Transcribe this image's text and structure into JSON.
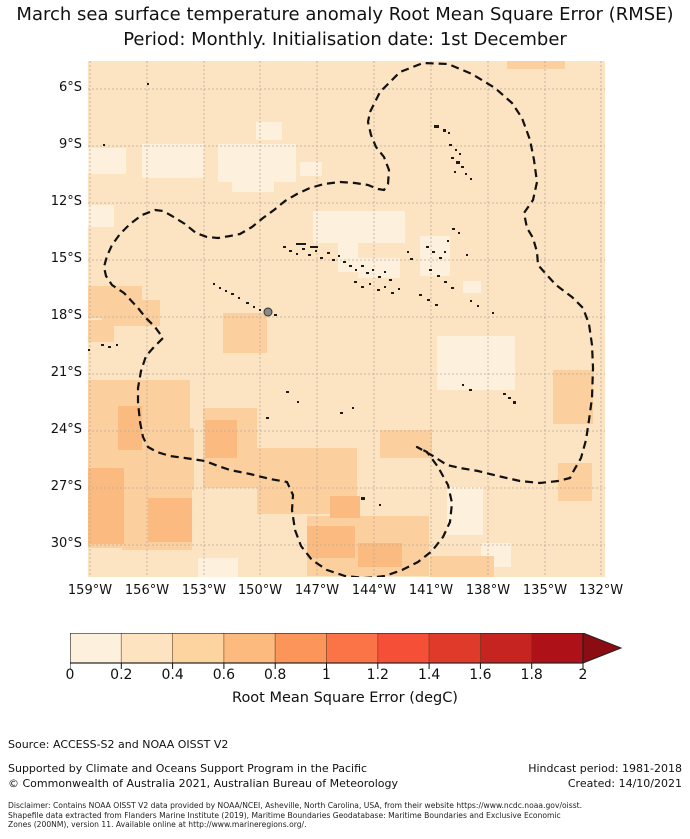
{
  "title": {
    "line1": "March sea surface temperature anomaly Root Mean Square Error (RMSE)",
    "line2": "Period: Monthly. Initialisation date: 1st December"
  },
  "map": {
    "x": 88,
    "y": 61,
    "width": 517,
    "height": 516,
    "base_color": "#fce3c1",
    "grid_color": "#b9ab9c",
    "lat_ticks": [
      "6°S",
      "9°S",
      "12°S",
      "15°S",
      "18°S",
      "21°S",
      "24°S",
      "27°S",
      "30°S"
    ],
    "lon_ticks": [
      "159°W",
      "156°W",
      "153°W",
      "150°W",
      "147°W",
      "144°W",
      "141°W",
      "138°W",
      "135°W",
      "132°W"
    ],
    "grid_ys": [
      89,
      146,
      203,
      260,
      317,
      374,
      431,
      488,
      545
    ],
    "grid_xs": [
      90,
      147,
      204,
      260,
      317,
      374,
      431,
      488,
      545,
      601
    ],
    "eez_boundary_color": "#111111",
    "eez_path": "M370,112 L380,92 L400,72 L423,63 L448,64 L472,74 L495,88 L512,103 L522,118 L530,140 L534,160 L537,182 L533,200 L524,213 L527,228 L533,238 L537,252 L538,265 L546,274 L556,285 L572,297 L583,308 L589,324 L592,345 L593,368 L592,398 L589,420 L586,440 L581,458 L573,472 L570,478 L558,481 L540,483 L520,481 L498,476 L478,471 L460,468 L447,465 L433,456 L417,447 L427,452 L438,467 L448,485 L452,503 L450,522 L443,537 L432,551 L418,562 L402,570 L385,576 L365,578 L345,576 L327,570 L312,560 L301,546 L295,530 L292,510 L293,495 L287,482 L270,479 L250,474 L230,470 L218,466 L205,461 L185,458 L170,456 L157,452 L148,447 L143,437 L140,422 L138,402 L138,388 L141,371 L146,356 L154,347 L163,338 L155,327 L146,318 L138,308 L124,293 L112,285 L106,276 L104,267 L107,256 L112,245 L120,234 L130,224 L142,215 L155,210 L163,211 L172,216 L185,224 L196,233 L207,237 L218,238 L230,236 L240,234 L252,227 L263,218 L274,210 L285,201 L297,194 L310,188 L324,184 L340,182 L355,183 L368,185 L378,189 L384,190 L388,184 L389,170 L384,157 L376,147 L371,135 L368,122 Z",
    "patches": [
      {
        "name": "rmse-0.0-0.2",
        "color": "#fdf0dc",
        "rects": [
          [
            88,
            148,
            38,
            26
          ],
          [
            142,
            144,
            62,
            34
          ],
          [
            218,
            144,
            78,
            38
          ],
          [
            232,
            180,
            42,
            12
          ],
          [
            256,
            122,
            26,
            18
          ],
          [
            300,
            162,
            22,
            14
          ],
          [
            313,
            211,
            92,
            32
          ],
          [
            338,
            240,
            20,
            32
          ],
          [
            358,
            258,
            42,
            20
          ],
          [
            420,
            236,
            30,
            40
          ],
          [
            463,
            281,
            18,
            12
          ],
          [
            437,
            336,
            78,
            54
          ],
          [
            447,
            487,
            36,
            48
          ],
          [
            481,
            543,
            30,
            24
          ],
          [
            198,
            558,
            40,
            20
          ],
          [
            88,
            205,
            26,
            22
          ]
        ]
      },
      {
        "name": "rmse-0.4-0.6",
        "color": "#fccf9e",
        "rects": [
          [
            88,
            286,
            54,
            32
          ],
          [
            102,
            300,
            58,
            26
          ],
          [
            88,
            380,
            102,
            70
          ],
          [
            110,
            428,
            84,
            62
          ],
          [
            88,
            448,
            44,
            100
          ],
          [
            122,
            486,
            70,
            64
          ],
          [
            203,
            408,
            54,
            80
          ],
          [
            223,
            313,
            44,
            40
          ],
          [
            257,
            448,
            100,
            66
          ],
          [
            307,
            516,
            122,
            60
          ],
          [
            380,
            430,
            52,
            28
          ],
          [
            553,
            370,
            40,
            54
          ],
          [
            558,
            463,
            34,
            38
          ],
          [
            507,
            55,
            58,
            14
          ],
          [
            88,
            320,
            26,
            22
          ],
          [
            430,
            556,
            64,
            21
          ],
          [
            95,
            530,
            65,
            16
          ]
        ]
      },
      {
        "name": "rmse-0.6-0.8",
        "color": "#fbba80",
        "rects": [
          [
            88,
            468,
            36,
            76
          ],
          [
            148,
            498,
            44,
            44
          ],
          [
            205,
            420,
            32,
            38
          ],
          [
            307,
            526,
            48,
            32
          ],
          [
            330,
            496,
            30,
            22
          ],
          [
            358,
            543,
            44,
            24
          ],
          [
            118,
            406,
            24,
            44
          ]
        ]
      }
    ],
    "island_color": "#1a1a1a",
    "islands": [
      [
        434,
        125,
        5,
        3
      ],
      [
        443,
        129,
        3,
        3
      ],
      [
        448,
        132,
        2,
        2
      ],
      [
        449,
        144,
        3,
        2
      ],
      [
        455,
        149,
        2,
        2
      ],
      [
        459,
        153,
        2,
        2
      ],
      [
        451,
        157,
        3,
        2
      ],
      [
        456,
        161,
        4,
        3
      ],
      [
        461,
        166,
        3,
        2
      ],
      [
        454,
        171,
        2,
        2
      ],
      [
        465,
        173,
        2,
        2
      ],
      [
        470,
        178,
        2,
        2
      ],
      [
        147,
        83,
        2,
        2
      ],
      [
        103,
        144,
        2,
        2
      ],
      [
        101,
        344,
        3,
        2
      ],
      [
        108,
        346,
        3,
        2
      ],
      [
        116,
        344,
        2,
        2
      ],
      [
        88,
        349,
        2,
        2
      ],
      [
        213,
        283,
        2,
        2
      ],
      [
        219,
        287,
        2,
        2
      ],
      [
        225,
        290,
        2,
        2
      ],
      [
        231,
        293,
        3,
        2
      ],
      [
        238,
        297,
        2,
        2
      ],
      [
        246,
        302,
        3,
        2
      ],
      [
        253,
        306,
        2,
        2
      ],
      [
        259,
        309,
        2,
        2
      ],
      [
        274,
        314,
        3,
        2
      ],
      [
        283,
        246,
        3,
        2
      ],
      [
        289,
        250,
        3,
        2
      ],
      [
        296,
        243,
        10,
        2
      ],
      [
        310,
        246,
        8,
        2
      ],
      [
        296,
        253,
        2,
        2
      ],
      [
        302,
        248,
        3,
        2
      ],
      [
        308,
        254,
        3,
        2
      ],
      [
        315,
        250,
        2,
        2
      ],
      [
        320,
        257,
        3,
        2
      ],
      [
        327,
        252,
        3,
        2
      ],
      [
        332,
        259,
        3,
        2
      ],
      [
        338,
        255,
        2,
        2
      ],
      [
        343,
        261,
        3,
        2
      ],
      [
        349,
        265,
        3,
        2
      ],
      [
        355,
        269,
        2,
        2
      ],
      [
        361,
        265,
        3,
        2
      ],
      [
        366,
        272,
        3,
        2
      ],
      [
        372,
        269,
        2,
        2
      ],
      [
        378,
        276,
        3,
        2
      ],
      [
        384,
        271,
        2,
        2
      ],
      [
        389,
        279,
        3,
        2
      ],
      [
        354,
        281,
        3,
        2
      ],
      [
        361,
        286,
        3,
        2
      ],
      [
        369,
        283,
        2,
        2
      ],
      [
        377,
        289,
        3,
        2
      ],
      [
        384,
        286,
        2,
        2
      ],
      [
        391,
        292,
        3,
        2
      ],
      [
        398,
        288,
        2,
        2
      ],
      [
        426,
        246,
        3,
        2
      ],
      [
        432,
        251,
        3,
        2
      ],
      [
        439,
        257,
        3,
        2
      ],
      [
        444,
        251,
        2,
        2
      ],
      [
        429,
        269,
        3,
        2
      ],
      [
        437,
        275,
        3,
        2
      ],
      [
        444,
        281,
        3,
        2
      ],
      [
        451,
        287,
        3,
        2
      ],
      [
        419,
        294,
        3,
        2
      ],
      [
        427,
        299,
        3,
        2
      ],
      [
        435,
        304,
        3,
        2
      ],
      [
        410,
        258,
        3,
        2
      ],
      [
        407,
        251,
        2,
        2
      ],
      [
        447,
        240,
        2,
        2
      ],
      [
        466,
        254,
        2,
        2
      ],
      [
        452,
        228,
        3,
        2
      ],
      [
        458,
        232,
        2,
        2
      ],
      [
        470,
        300,
        2,
        2
      ],
      [
        477,
        305,
        2,
        2
      ],
      [
        492,
        312,
        2,
        2
      ],
      [
        503,
        393,
        3,
        2
      ],
      [
        508,
        397,
        3,
        2
      ],
      [
        513,
        401,
        3,
        3
      ],
      [
        469,
        389,
        3,
        2
      ],
      [
        462,
        384,
        2,
        2
      ],
      [
        286,
        391,
        3,
        2
      ],
      [
        266,
        417,
        3,
        2
      ],
      [
        297,
        401,
        2,
        2
      ],
      [
        361,
        497,
        4,
        3
      ],
      [
        379,
        504,
        2,
        2
      ],
      [
        340,
        412,
        3,
        2
      ],
      [
        352,
        407,
        2,
        2
      ]
    ],
    "main_island": {
      "label": "tahiti",
      "cx": 268,
      "cy": 312,
      "r": 4,
      "fill": "#8a8a8a",
      "stroke": "#333333"
    }
  },
  "colorbar": {
    "x": 70,
    "y": 633,
    "height": 30,
    "segment_width": 51.3,
    "ticks": [
      "0",
      "0.2",
      "0.4",
      "0.6",
      "0.8",
      "1",
      "1.2",
      "1.4",
      "1.6",
      "1.8",
      "2"
    ],
    "colors": [
      "#fdf0dc",
      "#fde3c0",
      "#fdd3a0",
      "#fcba7e",
      "#fc9559",
      "#fa7448",
      "#f64f38",
      "#e03a2b",
      "#c52420",
      "#ae1117"
    ],
    "over_arrow_color": "#8b0c12",
    "arrow_tip_x": 621,
    "outline_color": "#222222",
    "label": "Root Mean Square Error (degC)"
  },
  "footer": {
    "source": "Source: ACCESS-S2 and NOAA OISST V2",
    "supported": "Supported by Climate and Oceans Support Program in the Pacific",
    "copyright": "© Commonwealth of Australia 2021, Australian Bureau of Meteorology",
    "hindcast": "Hindcast period: 1981-2018",
    "created": "Created: 14/10/2021",
    "disclaimer_lines": [
      "Disclaimer: Contains NOAA OISST V2 data provided by NOAA/NCEI, Asheville, North Carolina, USA, from their website https://www.ncdc.noaa.gov/oisst.",
      "Shapefile data extracted from Flanders Marine Institute (2019), Maritime Boundaries Geodatabase: Maritime Boundaries and Exclusive Economic",
      "Zones (200NM), version 11. Available online at http://www.marineregions.org/."
    ]
  }
}
